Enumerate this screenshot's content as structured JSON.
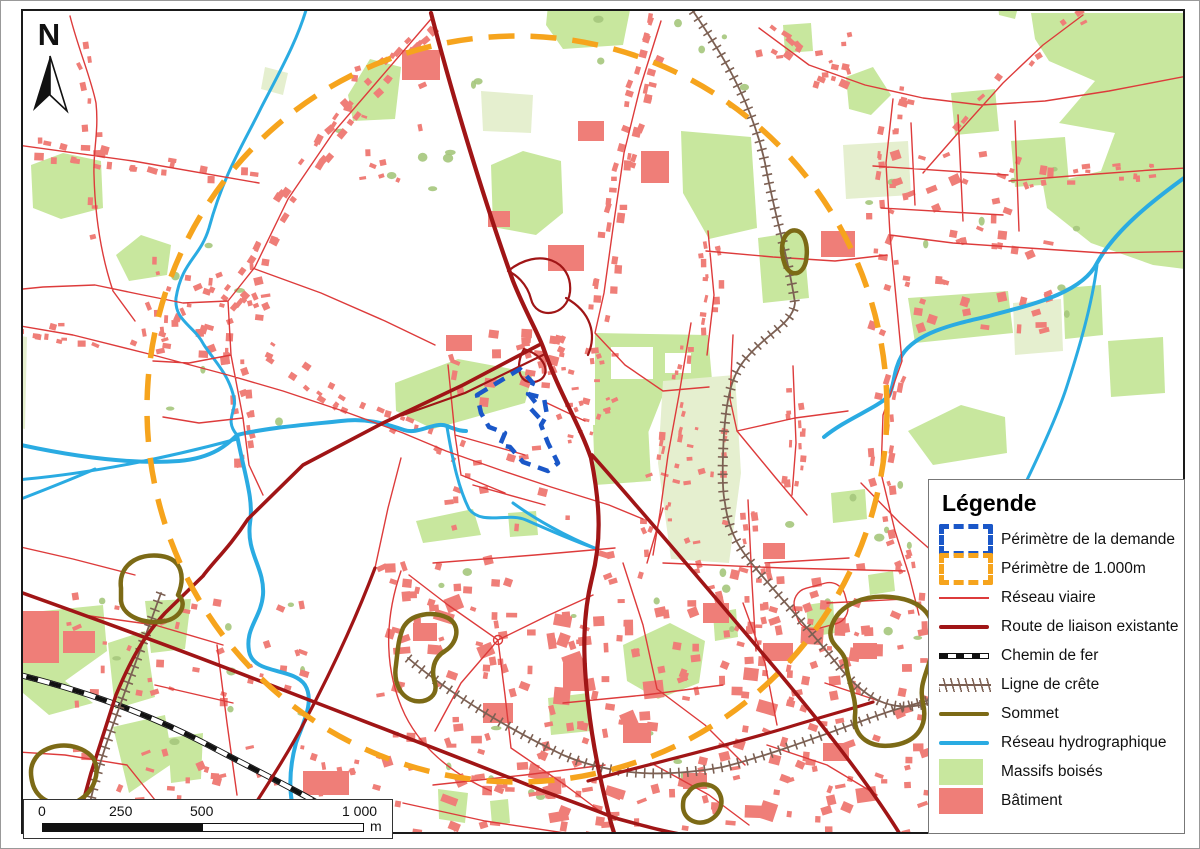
{
  "north_arrow": {
    "label": "N"
  },
  "scale_bar": {
    "ticks": [
      "0",
      "250",
      "500",
      "1 000"
    ],
    "unit": "m"
  },
  "legend": {
    "title": "Légende",
    "items": [
      {
        "id": "perimetre-demande",
        "label": "Périmètre de la demande",
        "symbol": "dashed-rect",
        "color_key": "perimeter_demande"
      },
      {
        "id": "perimetre-1000m",
        "label": "Périmètre de 1.000m",
        "symbol": "dashed-rect",
        "color_key": "perimeter_1000m"
      },
      {
        "id": "reseau-viaire",
        "label": "Réseau viaire",
        "symbol": "thin-line",
        "color_key": "road_minor"
      },
      {
        "id": "route-liaison-existante",
        "label": "Route de liaison existante",
        "symbol": "thick-line",
        "color_key": "road_major"
      },
      {
        "id": "chemin-de-fer",
        "label": "Chemin de fer",
        "symbol": "railway",
        "color_key": "railway"
      },
      {
        "id": "ligne-de-crete",
        "label": "Ligne de crête",
        "symbol": "ridge",
        "color_key": "ridge"
      },
      {
        "id": "sommet",
        "label": "Sommet",
        "symbol": "thick-line",
        "color_key": "summit"
      },
      {
        "id": "reseau-hydrographique",
        "label": "Réseau hydrographique",
        "symbol": "thick-line",
        "color_key": "water"
      },
      {
        "id": "massifs-boises",
        "label": "Massifs boisés",
        "symbol": "swatch",
        "color_key": "woodland"
      },
      {
        "id": "batiment",
        "label": "Bâtiment",
        "symbol": "swatch",
        "color_key": "building"
      }
    ]
  },
  "colors": {
    "perimeter_demande": "#1a57c8",
    "perimeter_1000m": "#f6a41d",
    "road_minor": "#dd3b3b",
    "road_major": "#a01516",
    "railway": "#111111",
    "ridge": "#7c6053",
    "summit": "#7c6a16",
    "water": "#2aabe2",
    "woodland": "#c8e79e",
    "woodland_pale": "#e5efcf",
    "tree": "#a5c77c",
    "building": "#ef7e78"
  }
}
